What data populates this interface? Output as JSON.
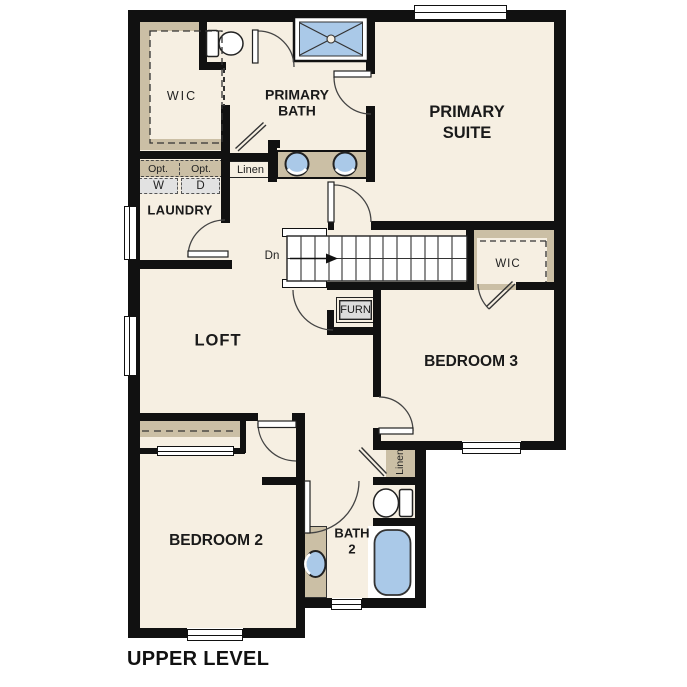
{
  "title": "UPPER LEVEL",
  "colors": {
    "wall": "#111111",
    "floor": "#f6efe2",
    "casework_tan": "#cbbfa5",
    "fixture_blue": "#aac9e8",
    "appliance_gray": "#e2e2e2",
    "background": "#ffffff"
  },
  "rooms": {
    "wic_primary": {
      "label": "WIC"
    },
    "primary_bath": {
      "line1": "PRIMARY",
      "line2": "BATH"
    },
    "primary_suite": {
      "line1": "PRIMARY",
      "line2": "SUITE"
    },
    "laundry": {
      "label": "LAUNDRY"
    },
    "loft": {
      "label": "LOFT"
    },
    "bedroom3": {
      "label": "BEDROOM 3"
    },
    "bedroom2": {
      "label": "BEDROOM 2"
    },
    "bath2": {
      "line1": "BATH",
      "line2": "2"
    },
    "wic_bedroom3": {
      "label": "WIC"
    }
  },
  "closets": {
    "linen_hall": "Linen",
    "linen_bath2": "Linen",
    "furnace": "FURN"
  },
  "laundry_appliances": {
    "washer_opt": "Opt.",
    "dryer_opt": "Opt.",
    "washer": "W",
    "dryer": "D"
  },
  "stairs": {
    "direction": "Dn"
  },
  "fixtures": [
    "shower",
    "toilet-primary",
    "double-vanity-sinks",
    "washer",
    "dryer",
    "furnace",
    "linen-closet",
    "toilet-bath2",
    "sink-bath2",
    "bathtub"
  ]
}
